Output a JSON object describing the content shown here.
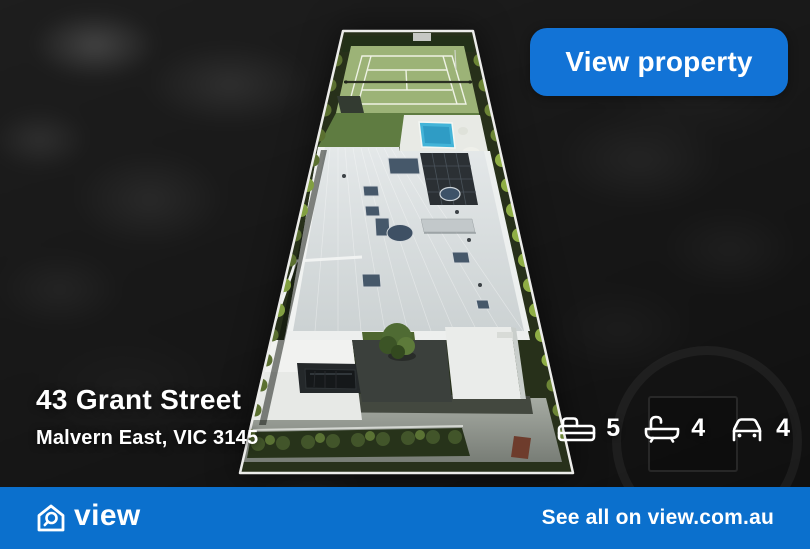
{
  "cta": {
    "label": "View property"
  },
  "property": {
    "address": "43 Grant Street",
    "location": "Malvern East, VIC 3145",
    "stats": [
      {
        "icon": "bed-icon",
        "value": "5"
      },
      {
        "icon": "bath-icon",
        "value": "4"
      },
      {
        "icon": "car-icon",
        "value": "4"
      }
    ]
  },
  "footer": {
    "brand": "view",
    "brand_icon": "house-magnifier-icon",
    "link_text": "See all on view.com.au"
  },
  "colors": {
    "accent_blue": "#1273d6",
    "footer_blue": "#0b70cd",
    "text_white": "#ffffff"
  }
}
